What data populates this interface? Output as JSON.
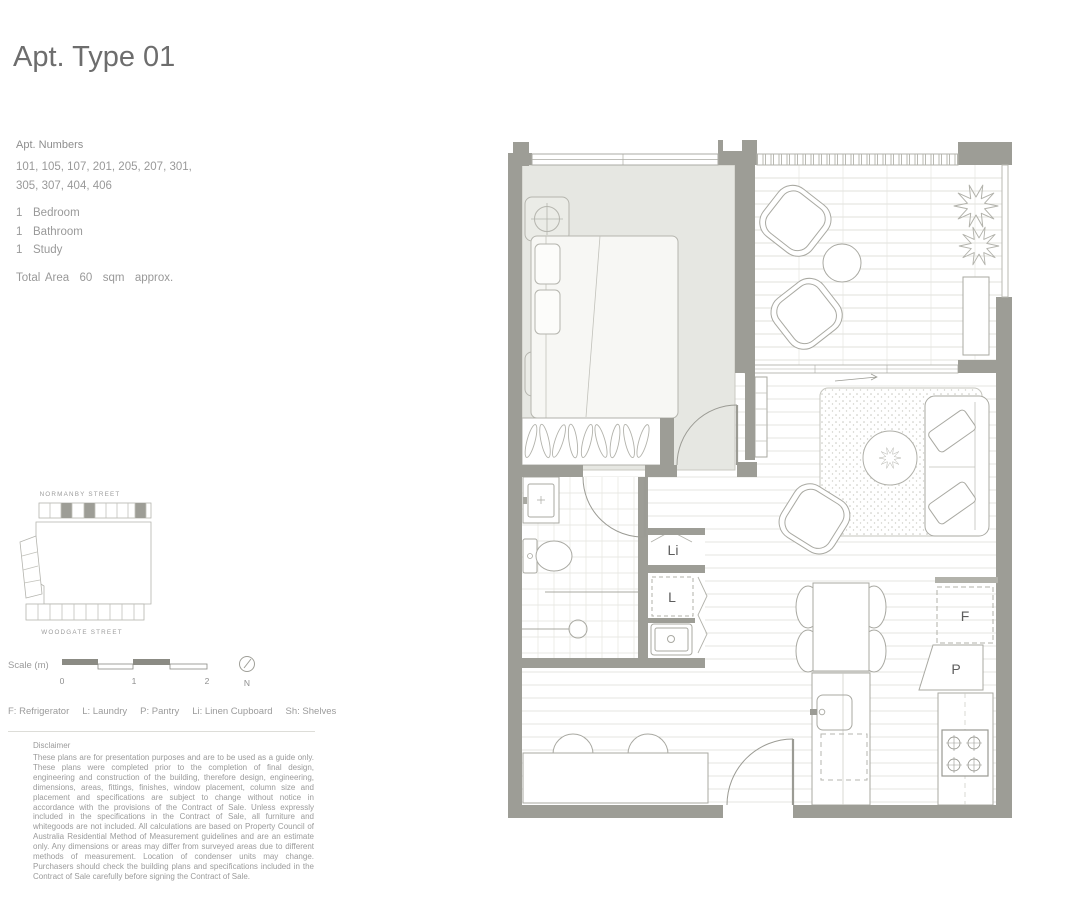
{
  "page": {
    "title": "Apt. Type 01"
  },
  "details": {
    "apt_numbers_label": "Apt. Numbers",
    "apt_numbers_lines": [
      "101, 105, 107, 201, 205, 207, 301,",
      "305, 307, 404, 406"
    ],
    "rooms": [
      {
        "count": "1",
        "label": "Bedroom"
      },
      {
        "count": "1",
        "label": "Bathroom"
      },
      {
        "count": "1",
        "label": "Study"
      }
    ],
    "total_area": "Total Area  60  sqm  approx."
  },
  "locator": {
    "street_top": "NORMANBY STREET",
    "street_bottom": "WOODGATE STREET"
  },
  "scale": {
    "label": "Scale (m)",
    "ticks": [
      "0",
      "1",
      "2"
    ],
    "north_label": "N"
  },
  "legend": {
    "items": [
      "F: Refrigerator",
      "L: Laundry",
      "P: Pantry",
      "Li: Linen Cupboard",
      "Sh: Shelves"
    ]
  },
  "floorplan": {
    "labels": {
      "linen": "Li",
      "laundry": "L",
      "fridge": "F",
      "pantry": "P"
    }
  },
  "disclaimer": {
    "heading": "Disclaimer",
    "body": "These plans are for presentation purposes and are to be used as a guide only. These plans were completed prior to the completion of final design, engineering and construction of the building, therefore design, engineering, dimensions, areas, fittings, finishes, window placement, column size and placement and specifications are subject to change without notice in accordance with the provisions of the Contract of Sale. Unless expressly included in the specifications in the Contract of Sale, all furniture and whitegoods are not included. All calculations are based on Property Council of Australia Residential Method of Measurement guidelines and are an estimate only. Any dimensions or areas may differ from surveyed areas due to different methods of measurement. Location of condenser units may change. Purchasers should check the building plans and specifications included in the Contract of Sale carefully before signing the Contract of Sale."
  },
  "colors": {
    "wall": "#9d9d96",
    "bedroom_floor": "#e6e7e2",
    "floor_line": "#dbdbd5",
    "title_text": "#6d6d6d",
    "body_text": "#999999",
    "plan_label_text": "#5d5d5d"
  }
}
